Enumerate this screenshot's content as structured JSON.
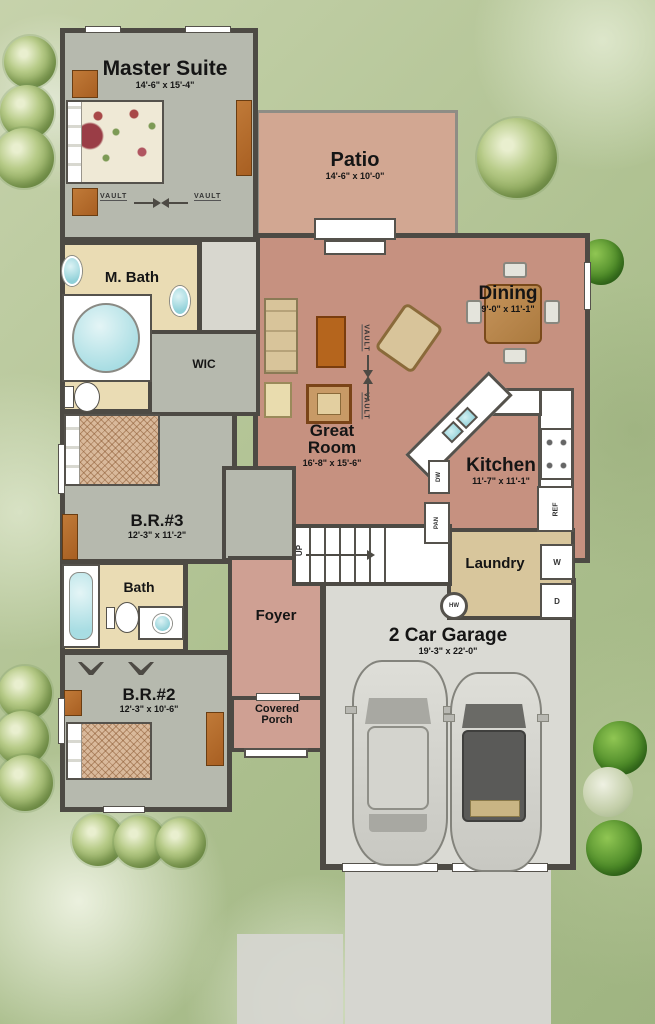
{
  "rooms": {
    "master_suite": {
      "name": "Master Suite",
      "dims": "14'-6\" x 15'-4\""
    },
    "patio": {
      "name": "Patio",
      "dims": "14'-6\" x 10'-0\""
    },
    "dining": {
      "name": "Dining",
      "dims": "9'-0\" x 11'-1\""
    },
    "master_bath": {
      "name": "M. Bath"
    },
    "wic": {
      "name": "WIC"
    },
    "great_room": {
      "name": "Great Room",
      "dims": "16'-8\" x 15'-6\""
    },
    "kitchen": {
      "name": "Kitchen",
      "dims": "11'-7\" x 11'-1\""
    },
    "bedroom3": {
      "name": "B.R.#3",
      "dims": "12'-3\" x 11'-2\""
    },
    "laundry": {
      "name": "Laundry"
    },
    "bath": {
      "name": "Bath"
    },
    "foyer": {
      "name": "Foyer"
    },
    "garage": {
      "name": "2 Car Garage",
      "dims": "19'-3\" x 22'-0\""
    },
    "bedroom2": {
      "name": "B.R.#2",
      "dims": "12'-3\" x 10'-6\""
    },
    "covered_porch": {
      "name": "Covered Porch"
    }
  },
  "annotations": {
    "vault": "VAULT",
    "up": "UP",
    "hot_water": "HW",
    "washer": "W",
    "dryer": "D",
    "refrigerator": "REF",
    "dishwasher": "DW",
    "pantry": "PAN"
  },
  "colors": {
    "wall": "#4d4a44",
    "floor_gray": "#b6b9ae",
    "floor_cream": "#eadcb4",
    "floor_salmon": "#c69180",
    "floor_pink": "#cfa093",
    "floor_khaki": "#d8c69c",
    "floor_garage": "#dadad4",
    "floor_patio": "#d2a792",
    "driveway": "#d6d6d0",
    "bed_tan": "#d9b99b",
    "fixture_teal": "#aadde2",
    "wood": "#b26b2e"
  }
}
